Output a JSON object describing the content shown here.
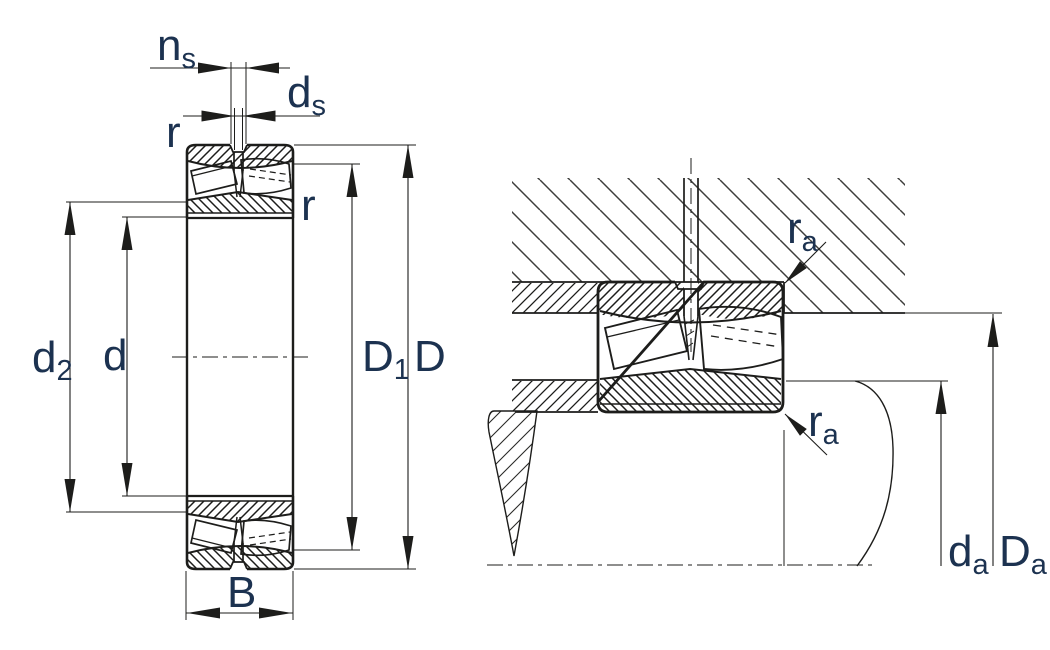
{
  "figure": {
    "kind": "bearing-dimension-diagram",
    "colors": {
      "line": "#1d1d1b",
      "label": "#1c3250",
      "background": "#ffffff",
      "housing_hatch": "#4a4a48"
    }
  },
  "left_view": {
    "labels": {
      "ns": {
        "main": "n",
        "sub": "s"
      },
      "ds": {
        "main": "d",
        "sub": "s"
      },
      "r_outer": {
        "main": "r",
        "sub": ""
      },
      "r_inner": {
        "main": "r",
        "sub": ""
      },
      "d2": {
        "main": "d",
        "sub": "2"
      },
      "d": {
        "main": "d",
        "sub": ""
      },
      "D1": {
        "main": "D",
        "sub": "1"
      },
      "D": {
        "main": "D",
        "sub": ""
      },
      "B": {
        "main": "B",
        "sub": ""
      }
    }
  },
  "right_view": {
    "labels": {
      "ra_upper": {
        "main": "r",
        "sub": "a"
      },
      "ra_lower": {
        "main": "r",
        "sub": "a"
      },
      "da": {
        "main": "d",
        "sub": "a"
      },
      "Da": {
        "main": "D",
        "sub": "a"
      }
    }
  }
}
